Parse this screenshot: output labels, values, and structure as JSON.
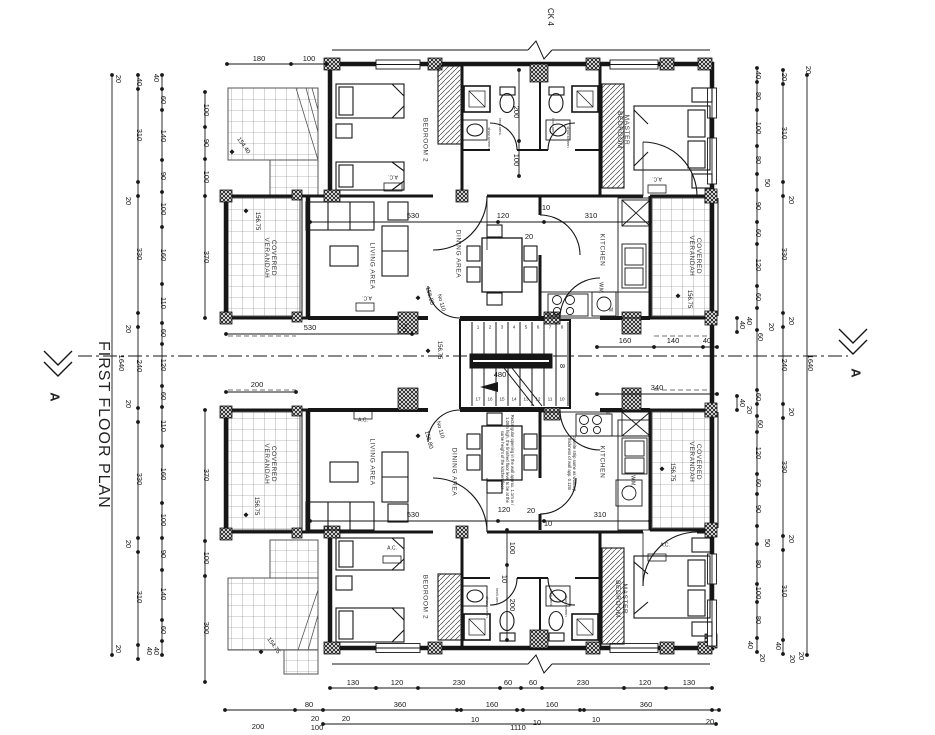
{
  "titles": {
    "plan_title": "FIRST FLOOR PLAN",
    "grid_marker": "CK 4",
    "section_label": "A"
  },
  "room_labels": [
    {
      "t": "BEDROOM 2",
      "x": 424,
      "y": 140,
      "r": 90
    },
    {
      "t": "MASTER\nBEDROOM",
      "x": 622,
      "y": 130,
      "r": 90
    },
    {
      "t": "LIVING AREA",
      "x": 371,
      "y": 266,
      "r": 90
    },
    {
      "t": "DINING AREA",
      "x": 457,
      "y": 254,
      "r": 90
    },
    {
      "t": "KITCHEN",
      "x": 601,
      "y": 250,
      "r": 90
    },
    {
      "t": "COVERED\nVERANDAH",
      "x": 269,
      "y": 258,
      "r": 90
    },
    {
      "t": "COVERED\nVERANDAH",
      "x": 694,
      "y": 256,
      "r": 90
    },
    {
      "t": "LIVING AREA",
      "x": 371,
      "y": 462,
      "r": 90
    },
    {
      "t": "DINING AREA",
      "x": 453,
      "y": 472,
      "r": 90
    },
    {
      "t": "KITCHEN",
      "x": 601,
      "y": 462,
      "r": 90
    },
    {
      "t": "COVERED\nVERANDAH",
      "x": 269,
      "y": 464,
      "r": 90
    },
    {
      "t": "COVERED\nVERANDAH",
      "x": 694,
      "y": 462,
      "r": 90
    },
    {
      "t": "BEDROOM 2",
      "x": 424,
      "y": 597,
      "r": 90
    },
    {
      "t": "MASTER\nBEDROOM",
      "x": 620,
      "y": 599,
      "r": 90
    }
  ],
  "dim_labels": [
    {
      "t": "20",
      "x": 118,
      "y": 79,
      "r": 90
    },
    {
      "t": "1640",
      "x": 121,
      "y": 363,
      "r": 90
    },
    {
      "t": "20",
      "x": 118,
      "y": 649,
      "r": 90
    },
    {
      "t": "40",
      "x": 139,
      "y": 82,
      "r": 90
    },
    {
      "t": "310",
      "x": 139,
      "y": 135,
      "r": 90
    },
    {
      "t": "20",
      "x": 128,
      "y": 201,
      "r": 90
    },
    {
      "t": "330",
      "x": 139,
      "y": 254,
      "r": 90
    },
    {
      "t": "20",
      "x": 128,
      "y": 329,
      "r": 90
    },
    {
      "t": "240",
      "x": 139,
      "y": 366,
      "r": 90
    },
    {
      "t": "20",
      "x": 128,
      "y": 404,
      "r": 90
    },
    {
      "t": "330",
      "x": 139,
      "y": 479,
      "r": 90
    },
    {
      "t": "20",
      "x": 128,
      "y": 544,
      "r": 90
    },
    {
      "t": "310",
      "x": 139,
      "y": 597,
      "r": 90
    },
    {
      "t": "40",
      "x": 149,
      "y": 651,
      "r": 90
    },
    {
      "t": "40",
      "x": 156,
      "y": 78,
      "r": 90
    },
    {
      "t": "60",
      "x": 163,
      "y": 100,
      "r": 90
    },
    {
      "t": "140",
      "x": 163,
      "y": 136,
      "r": 90
    },
    {
      "t": "90",
      "x": 163,
      "y": 176,
      "r": 90
    },
    {
      "t": "100",
      "x": 163,
      "y": 209,
      "r": 90
    },
    {
      "t": "160",
      "x": 163,
      "y": 255,
      "r": 90
    },
    {
      "t": "110",
      "x": 163,
      "y": 303,
      "r": 90
    },
    {
      "t": "60",
      "x": 163,
      "y": 333,
      "r": 90
    },
    {
      "t": "120",
      "x": 163,
      "y": 365,
      "r": 90
    },
    {
      "t": "60",
      "x": 163,
      "y": 396,
      "r": 90
    },
    {
      "t": "110",
      "x": 163,
      "y": 426,
      "r": 90
    },
    {
      "t": "160",
      "x": 163,
      "y": 474,
      "r": 90
    },
    {
      "t": "100",
      "x": 163,
      "y": 520,
      "r": 90
    },
    {
      "t": "90",
      "x": 163,
      "y": 554,
      "r": 90
    },
    {
      "t": "140",
      "x": 163,
      "y": 594,
      "r": 90
    },
    {
      "t": "60",
      "x": 163,
      "y": 630,
      "r": 90
    },
    {
      "t": "40",
      "x": 156,
      "y": 651,
      "r": 90
    },
    {
      "t": "100",
      "x": 206,
      "y": 110,
      "r": 90
    },
    {
      "t": "90",
      "x": 206,
      "y": 143,
      "r": 90
    },
    {
      "t": "100",
      "x": 206,
      "y": 177,
      "r": 90
    },
    {
      "t": "370",
      "x": 206,
      "y": 257,
      "r": 90
    },
    {
      "t": "370",
      "x": 206,
      "y": 475,
      "r": 90
    },
    {
      "t": "100",
      "x": 206,
      "y": 558,
      "r": 90
    },
    {
      "t": "300",
      "x": 206,
      "y": 628,
      "r": 90
    },
    {
      "t": "40",
      "x": 758,
      "y": 75,
      "r": 90
    },
    {
      "t": "80",
      "x": 758,
      "y": 96,
      "r": 90
    },
    {
      "t": "100",
      "x": 758,
      "y": 128,
      "r": 90
    },
    {
      "t": "80",
      "x": 758,
      "y": 160,
      "r": 90
    },
    {
      "t": "50",
      "x": 767,
      "y": 183,
      "r": 90
    },
    {
      "t": "90",
      "x": 758,
      "y": 206,
      "r": 90
    },
    {
      "t": "60",
      "x": 758,
      "y": 233,
      "r": 90
    },
    {
      "t": "120",
      "x": 758,
      "y": 265,
      "r": 90
    },
    {
      "t": "60",
      "x": 758,
      "y": 297,
      "r": 90
    },
    {
      "t": "40",
      "x": 749,
      "y": 321,
      "r": 90
    },
    {
      "t": "60",
      "x": 760,
      "y": 337,
      "r": 90
    },
    {
      "t": "20",
      "x": 771,
      "y": 327,
      "r": 90
    },
    {
      "t": "60",
      "x": 758,
      "y": 397,
      "r": 90
    },
    {
      "t": "20",
      "x": 749,
      "y": 410,
      "r": 90
    },
    {
      "t": "60",
      "x": 760,
      "y": 424,
      "r": 90
    },
    {
      "t": "120",
      "x": 758,
      "y": 453,
      "r": 90
    },
    {
      "t": "60",
      "x": 758,
      "y": 483,
      "r": 90
    },
    {
      "t": "90",
      "x": 758,
      "y": 509,
      "r": 90
    },
    {
      "t": "50",
      "x": 767,
      "y": 543,
      "r": 90
    },
    {
      "t": "80",
      "x": 758,
      "y": 564,
      "r": 90
    },
    {
      "t": "100",
      "x": 758,
      "y": 593,
      "r": 90
    },
    {
      "t": "80",
      "x": 758,
      "y": 620,
      "r": 90
    },
    {
      "t": "40",
      "x": 750,
      "y": 645,
      "r": 90
    },
    {
      "t": "20",
      "x": 762,
      "y": 658,
      "r": 90
    },
    {
      "t": "20",
      "x": 784,
      "y": 77,
      "r": 90
    },
    {
      "t": "310",
      "x": 784,
      "y": 133,
      "r": 90
    },
    {
      "t": "20",
      "x": 791,
      "y": 200,
      "r": 90
    },
    {
      "t": "330",
      "x": 784,
      "y": 254,
      "r": 90
    },
    {
      "t": "20",
      "x": 791,
      "y": 321,
      "r": 90
    },
    {
      "t": "240",
      "x": 784,
      "y": 365,
      "r": 90
    },
    {
      "t": "20",
      "x": 791,
      "y": 412,
      "r": 90
    },
    {
      "t": "330",
      "x": 784,
      "y": 467,
      "r": 90
    },
    {
      "t": "20",
      "x": 791,
      "y": 539,
      "r": 90
    },
    {
      "t": "310",
      "x": 784,
      "y": 591,
      "r": 90
    },
    {
      "t": "40",
      "x": 778,
      "y": 646,
      "r": 90
    },
    {
      "t": "20",
      "x": 792,
      "y": 659,
      "r": 90
    },
    {
      "t": "20",
      "x": 808,
      "y": 70,
      "r": 90
    },
    {
      "t": "1640",
      "x": 810,
      "y": 363,
      "r": 90
    },
    {
      "t": "20",
      "x": 801,
      "y": 656,
      "r": 90
    },
    {
      "t": "180",
      "x": 259,
      "y": 59
    },
    {
      "t": "100",
      "x": 309,
      "y": 59
    },
    {
      "t": "130",
      "x": 353,
      "y": 683
    },
    {
      "t": "120",
      "x": 397,
      "y": 683
    },
    {
      "t": "230",
      "x": 459,
      "y": 683
    },
    {
      "t": "60",
      "x": 508,
      "y": 683
    },
    {
      "t": "60",
      "x": 533,
      "y": 683
    },
    {
      "t": "230",
      "x": 583,
      "y": 683
    },
    {
      "t": "120",
      "x": 645,
      "y": 683
    },
    {
      "t": "130",
      "x": 689,
      "y": 683
    },
    {
      "t": "200",
      "x": 258,
      "y": 727
    },
    {
      "t": "80",
      "x": 309,
      "y": 705
    },
    {
      "t": "20",
      "x": 315,
      "y": 719
    },
    {
      "t": "100",
      "x": 317,
      "y": 728
    },
    {
      "t": "20",
      "x": 346,
      "y": 719
    },
    {
      "t": "360",
      "x": 400,
      "y": 705
    },
    {
      "t": "10",
      "x": 475,
      "y": 720
    },
    {
      "t": "160",
      "x": 492,
      "y": 705
    },
    {
      "t": "10",
      "x": 537,
      "y": 723
    },
    {
      "t": "160",
      "x": 552,
      "y": 705
    },
    {
      "t": "10",
      "x": 596,
      "y": 720
    },
    {
      "t": "360",
      "x": 646,
      "y": 705
    },
    {
      "t": "20",
      "x": 710,
      "y": 722
    },
    {
      "t": "1110",
      "x": 518,
      "y": 728
    },
    {
      "t": "530",
      "x": 413,
      "y": 216
    },
    {
      "t": "120",
      "x": 503,
      "y": 216
    },
    {
      "t": "10",
      "x": 546,
      "y": 208
    },
    {
      "t": "310",
      "x": 591,
      "y": 216
    },
    {
      "t": "20",
      "x": 529,
      "y": 237
    },
    {
      "t": "530",
      "x": 310,
      "y": 328
    },
    {
      "t": "160",
      "x": 625,
      "y": 341
    },
    {
      "t": "140",
      "x": 673,
      "y": 341
    },
    {
      "t": "40",
      "x": 707,
      "y": 341
    },
    {
      "t": "200",
      "x": 257,
      "y": 385
    },
    {
      "t": "340",
      "x": 657,
      "y": 388
    },
    {
      "t": "480",
      "x": 500,
      "y": 375
    },
    {
      "t": "530",
      "x": 413,
      "y": 515
    },
    {
      "t": "120",
      "x": 504,
      "y": 510
    },
    {
      "t": "20",
      "x": 531,
      "y": 511
    },
    {
      "t": "10",
      "x": 548,
      "y": 524
    },
    {
      "t": "310",
      "x": 600,
      "y": 515
    },
    {
      "t": "200",
      "x": 516,
      "y": 112,
      "r": 90
    },
    {
      "t": "100",
      "x": 516,
      "y": 160,
      "r": 90
    },
    {
      "t": "100",
      "x": 512,
      "y": 548,
      "r": 90
    },
    {
      "t": "10",
      "x": 504,
      "y": 579,
      "r": 90
    },
    {
      "t": "200",
      "x": 512,
      "y": 605,
      "r": 90
    },
    {
      "t": "40",
      "x": 742,
      "y": 325,
      "r": 90
    },
    {
      "t": "40",
      "x": 742,
      "y": 403,
      "r": 90
    },
    {
      "t": "50",
      "x": 404,
      "y": 328,
      "r": 90
    },
    {
      "t": "8",
      "x": 562,
      "y": 366,
      "r": 90
    }
  ],
  "level_markers": [
    {
      "t": "154.40",
      "x": 243,
      "y": 146,
      "r": 55,
      "dx": 232,
      "dy": 153
    },
    {
      "t": "156.75",
      "x": 257,
      "y": 221,
      "r": 90,
      "dx": 246,
      "dy": 212
    },
    {
      "t": "156.75",
      "x": 689,
      "y": 299,
      "r": 90,
      "dx": 678,
      "dy": 297
    },
    {
      "t": "156.75",
      "x": 439,
      "y": 350,
      "r": 90,
      "dx": 428,
      "dy": 352
    },
    {
      "t": "156.75",
      "x": 256,
      "y": 506,
      "r": 90,
      "dx": 246,
      "dy": 516
    },
    {
      "t": "156.75",
      "x": 672,
      "y": 472,
      "r": 90,
      "dx": 662,
      "dy": 470
    },
    {
      "t": "154.75",
      "x": 273,
      "y": 646,
      "r": 55,
      "dx": 261,
      "dy": 653
    },
    {
      "t": "156.80",
      "x": 429,
      "y": 296,
      "r": 75,
      "dx": 418,
      "dy": 299
    },
    {
      "t": "156.80",
      "x": 428,
      "y": 440,
      "r": 75,
      "dx": 418,
      "dy": 437
    }
  ],
  "door_numbers": [
    {
      "t": "No 110",
      "x": 440,
      "y": 303,
      "r": 75
    },
    {
      "t": "No 110",
      "x": 439,
      "y": 430,
      "r": 75
    }
  ],
  "fixture_labels": [
    {
      "t": "A.C.",
      "x": 393,
      "y": 176,
      "r": 180
    },
    {
      "t": "A.C.",
      "x": 657,
      "y": 178,
      "r": 180
    },
    {
      "t": "A.C.",
      "x": 367,
      "y": 297,
      "r": 180
    },
    {
      "t": "A.C.",
      "x": 363,
      "y": 421
    },
    {
      "t": "A.C.",
      "x": 392,
      "y": 549
    },
    {
      "t": "A.C.",
      "x": 665,
      "y": 546
    },
    {
      "t": "W.M.",
      "x": 600,
      "y": 288,
      "r": 90
    },
    {
      "t": "W.M.",
      "x": 632,
      "y": 481,
      "r": 90
    },
    {
      "t": "M",
      "x": 611,
      "y": 311
    },
    {
      "t": "M",
      "x": 608,
      "y": 413
    }
  ],
  "vent_labels": [
    {
      "t": "tech.vent.",
      "x": 500,
      "y": 127,
      "r": 90
    },
    {
      "t": "shov.screen",
      "x": 489,
      "y": 138,
      "r": 90
    },
    {
      "t": "tech.vent.",
      "x": 553,
      "y": 127,
      "r": 90
    },
    {
      "t": "shov.screen",
      "x": 568,
      "y": 137,
      "r": 90
    },
    {
      "t": "tech.vent.",
      "x": 497,
      "y": 597,
      "r": 90
    },
    {
      "t": "shov.screen",
      "x": 487,
      "y": 607,
      "r": 90
    },
    {
      "t": "tech.vent.",
      "x": 551,
      "y": 598,
      "r": 90
    },
    {
      "t": "shov.screen",
      "x": 566,
      "y": 606,
      "r": 90
    }
  ],
  "notes": [
    {
      "t": "Rectangular opening in the wall approx. 1.1m w / 1.05m high, the finished floor level to be at the same height of the kitchen floor",
      "x": 507,
      "y": 460,
      "r": 90,
      "w": 95
    },
    {
      "t": "Granite strip same as worktop, thickness of wall app. 0.12m",
      "x": 571,
      "y": 464,
      "r": 90,
      "w": 72
    }
  ],
  "stair": {
    "width_label": "480",
    "top_steps": [
      "1",
      "2",
      "3",
      "4",
      "5",
      "6",
      "7",
      "8"
    ],
    "bottom_steps": [
      "17",
      "16",
      "15",
      "14",
      "13",
      "12",
      "11",
      "10"
    ]
  }
}
